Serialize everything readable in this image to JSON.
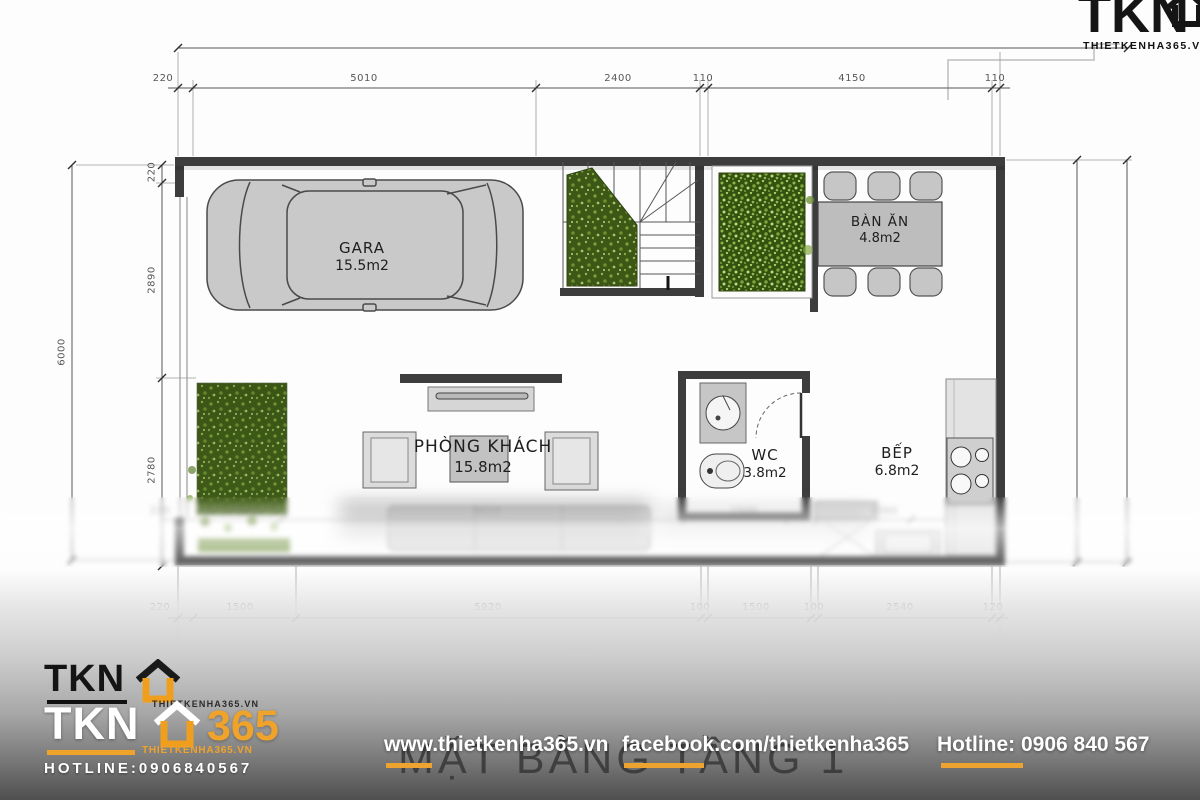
{
  "plan": {
    "title": "MẶT BẰNG TẦNG 1",
    "rooms": {
      "gara": {
        "name": "GARA",
        "area": "15.5m2"
      },
      "ban_an": {
        "name": "BÀN ĂN",
        "area": "4.8m2"
      },
      "phong_khach": {
        "name": "PHÒNG KHÁCH",
        "area": "15.8m2"
      },
      "wc": {
        "name": "WC",
        "area": "3.8m2"
      },
      "bep": {
        "name": "BẾP",
        "area": "6.8m2"
      }
    },
    "dims": {
      "top_row": [
        "220",
        "5010",
        "2400",
        "110",
        "4150",
        "110"
      ],
      "left_total": "6000",
      "left_row": [
        "220",
        "2890",
        "2780"
      ],
      "mid_row": [
        "220",
        "1500",
        "5010",
        "1500",
        "1360"
      ],
      "bottom_row": [
        "220",
        "1500",
        "5920",
        "100",
        "1500",
        "100",
        "2540",
        "120"
      ],
      "bottom_total": "12000"
    }
  },
  "branding": {
    "top_logo": {
      "name": "TKN",
      "site": "THIETKENHA365.VN"
    },
    "bottom_logo": {
      "line1": "TKN",
      "line1_site": "THIETKENHA365.VN",
      "line2": "TKN",
      "line2_suffix": "365",
      "line2_site": "THIETKENHA365.VN",
      "hotline": "HOTLINE:0906840567"
    },
    "footer": {
      "website": "www.thietkenha365.vn",
      "facebook": "facebook.com/thietkenha365",
      "hotline": "Hotline: 0906 840 567"
    },
    "colors": {
      "accent_orange": "#f0a32a",
      "plant_green": "#3c5716"
    }
  }
}
